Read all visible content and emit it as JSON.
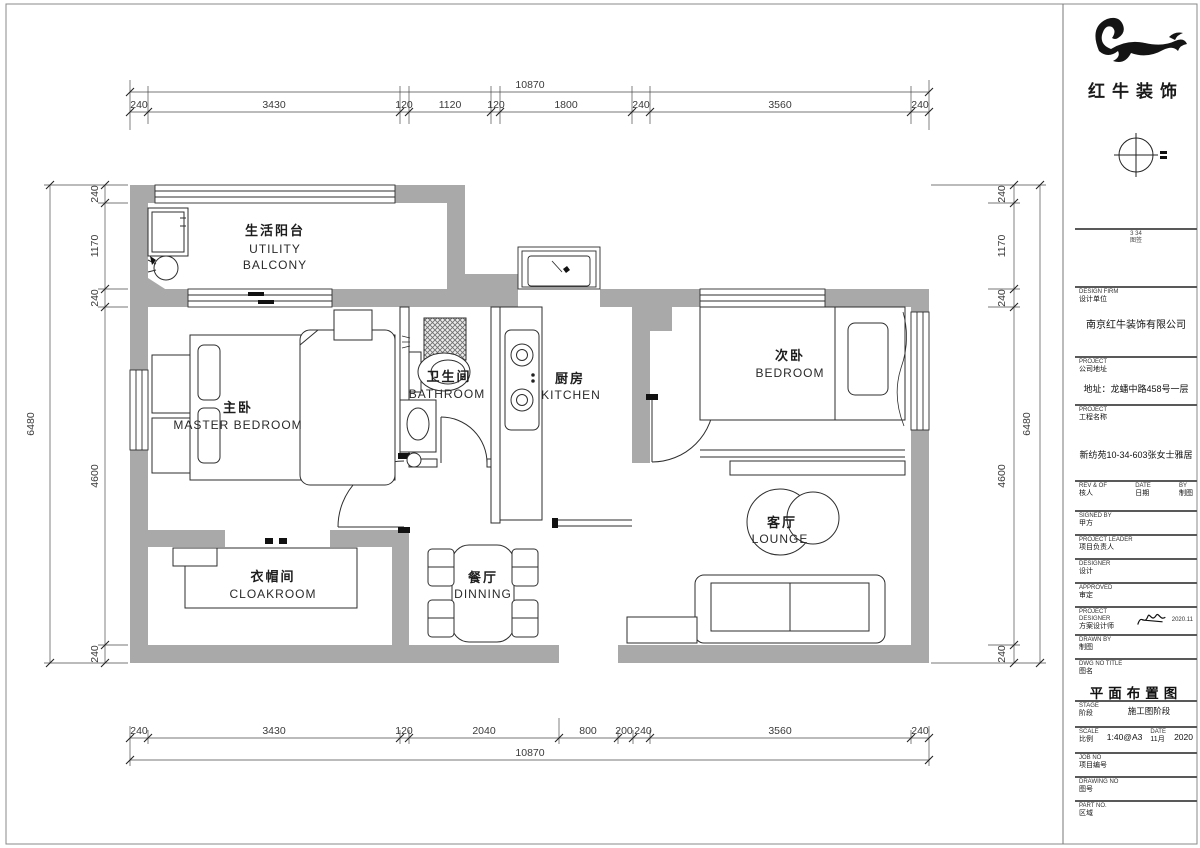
{
  "rooms": {
    "balcony": {
      "zh": "生活阳台",
      "en1": "UTILITY",
      "en2": "BALCONY"
    },
    "master": {
      "zh": "主卧",
      "en": "MASTER BEDROOM"
    },
    "bathroom": {
      "zh": "卫生间",
      "en": "BATHROOM"
    },
    "kitchen": {
      "zh": "厨房",
      "en": "KITCHEN"
    },
    "bedroom2": {
      "zh": "次卧",
      "en": "BEDROOM"
    },
    "cloakroom": {
      "zh": "衣帽间",
      "en": "CLOAKROOM"
    },
    "dining": {
      "zh": "餐厅",
      "en": "DINNING"
    },
    "lounge": {
      "zh": "客厅",
      "en": "LOUNGE"
    }
  },
  "dims": {
    "top": {
      "overall": "10870",
      "segments": [
        "240",
        "3430",
        "120",
        "1120",
        "120",
        "1800",
        "240",
        "3560",
        "240"
      ]
    },
    "bottom": {
      "overall": "10870",
      "segments": [
        "240",
        "3430",
        "120",
        "2040",
        "800",
        "200",
        "240",
        "3560",
        "240"
      ]
    },
    "left": {
      "overall": "6480",
      "segments": [
        "240",
        "1170",
        "240",
        "4600",
        "240"
      ]
    },
    "right": {
      "overall": "6480",
      "segments": [
        "240",
        "1170",
        "240",
        "4600",
        "240"
      ]
    }
  },
  "tb": {
    "brand": "红牛装饰",
    "note1": "3 34",
    "note2": "图签",
    "firm_en": "DESIGN FIRM",
    "firm_zh": "设计单位",
    "firm": "南京红牛装饰有限公司",
    "addr_en": "PROJECT",
    "addr_zh": "公司地址",
    "addr": "地址：龙蟠中路458号一层",
    "proj_en": "PROJECT",
    "proj_zh": "工程名称",
    "proj": "新纺苑10-34-603张女士雅居",
    "c1_en": "REV & OF",
    "c1_zh": "核人",
    "c2_en": "DATE",
    "c2_zh": "日期",
    "c3_en": "BY",
    "c3_zh": "制图",
    "client_en": "SIGNED BY",
    "client_zh": "甲方",
    "leader_en": "PROJECT LEADER",
    "leader_zh": "项目负责人",
    "designer_en": "DESIGNER",
    "designer_zh": "设计",
    "approved_en": "APPROVED",
    "approved_zh": "审定",
    "pd_en": "PROJECT DESIGNER",
    "pd_zh": "方案设计师",
    "pd_sig": "2020.11",
    "drawn_en": "DRAWN BY",
    "drawn_zh": "制图",
    "dwg_en": "DWG NO TITLE",
    "dwg_zh": "图名",
    "title": "平面布置图",
    "stage_en": "STAGE",
    "stage_zh": "阶段",
    "stage": "施工图阶段",
    "scale_en": "SCALE",
    "scale_zh": "比例",
    "scale": "1:40@A3",
    "date_en": "DATE",
    "date_zh": "日期",
    "date_m": "11月",
    "date_y": "2020",
    "job_en": "JOB NO",
    "job_zh": "项目编号",
    "no_en": "DRAWING NO",
    "no_zh": "图号",
    "part_en": "PART NO.",
    "part_zh": "区域"
  }
}
